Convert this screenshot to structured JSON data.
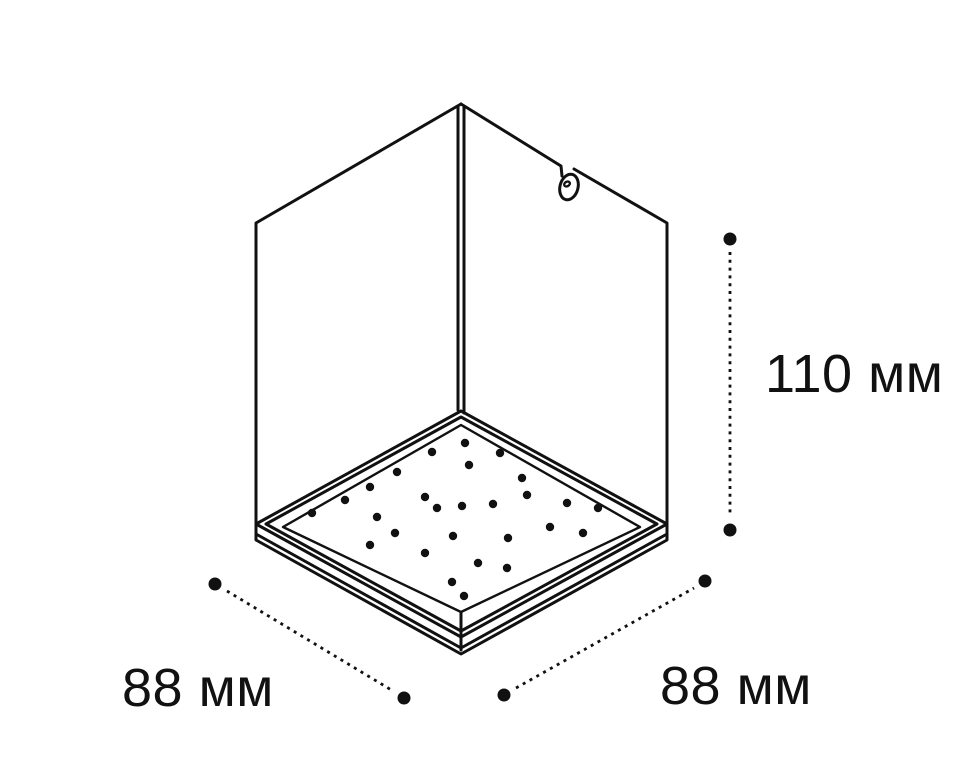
{
  "diagram": {
    "background_color": "#ffffff",
    "line_color": "#111111",
    "labels": {
      "height": "110 мм",
      "depth": "88 мм",
      "width": "88 мм"
    },
    "led_dots": [
      [
        465,
        443
      ],
      [
        432,
        452
      ],
      [
        500,
        453
      ],
      [
        469,
        465
      ],
      [
        397,
        472
      ],
      [
        522,
        478
      ],
      [
        370,
        487
      ],
      [
        425,
        497
      ],
      [
        527,
        495
      ],
      [
        345,
        500
      ],
      [
        437,
        508
      ],
      [
        462,
        506
      ],
      [
        493,
        504
      ],
      [
        567,
        503
      ],
      [
        598,
        508
      ],
      [
        312,
        513
      ],
      [
        377,
        517
      ],
      [
        550,
        527
      ],
      [
        395,
        533
      ],
      [
        453,
        536
      ],
      [
        583,
        533
      ],
      [
        508,
        538
      ],
      [
        370,
        545
      ],
      [
        425,
        553
      ],
      [
        478,
        563
      ],
      [
        507,
        568
      ],
      [
        452,
        582
      ],
      [
        464,
        596
      ]
    ],
    "led_dot_radius": 4.2
  }
}
